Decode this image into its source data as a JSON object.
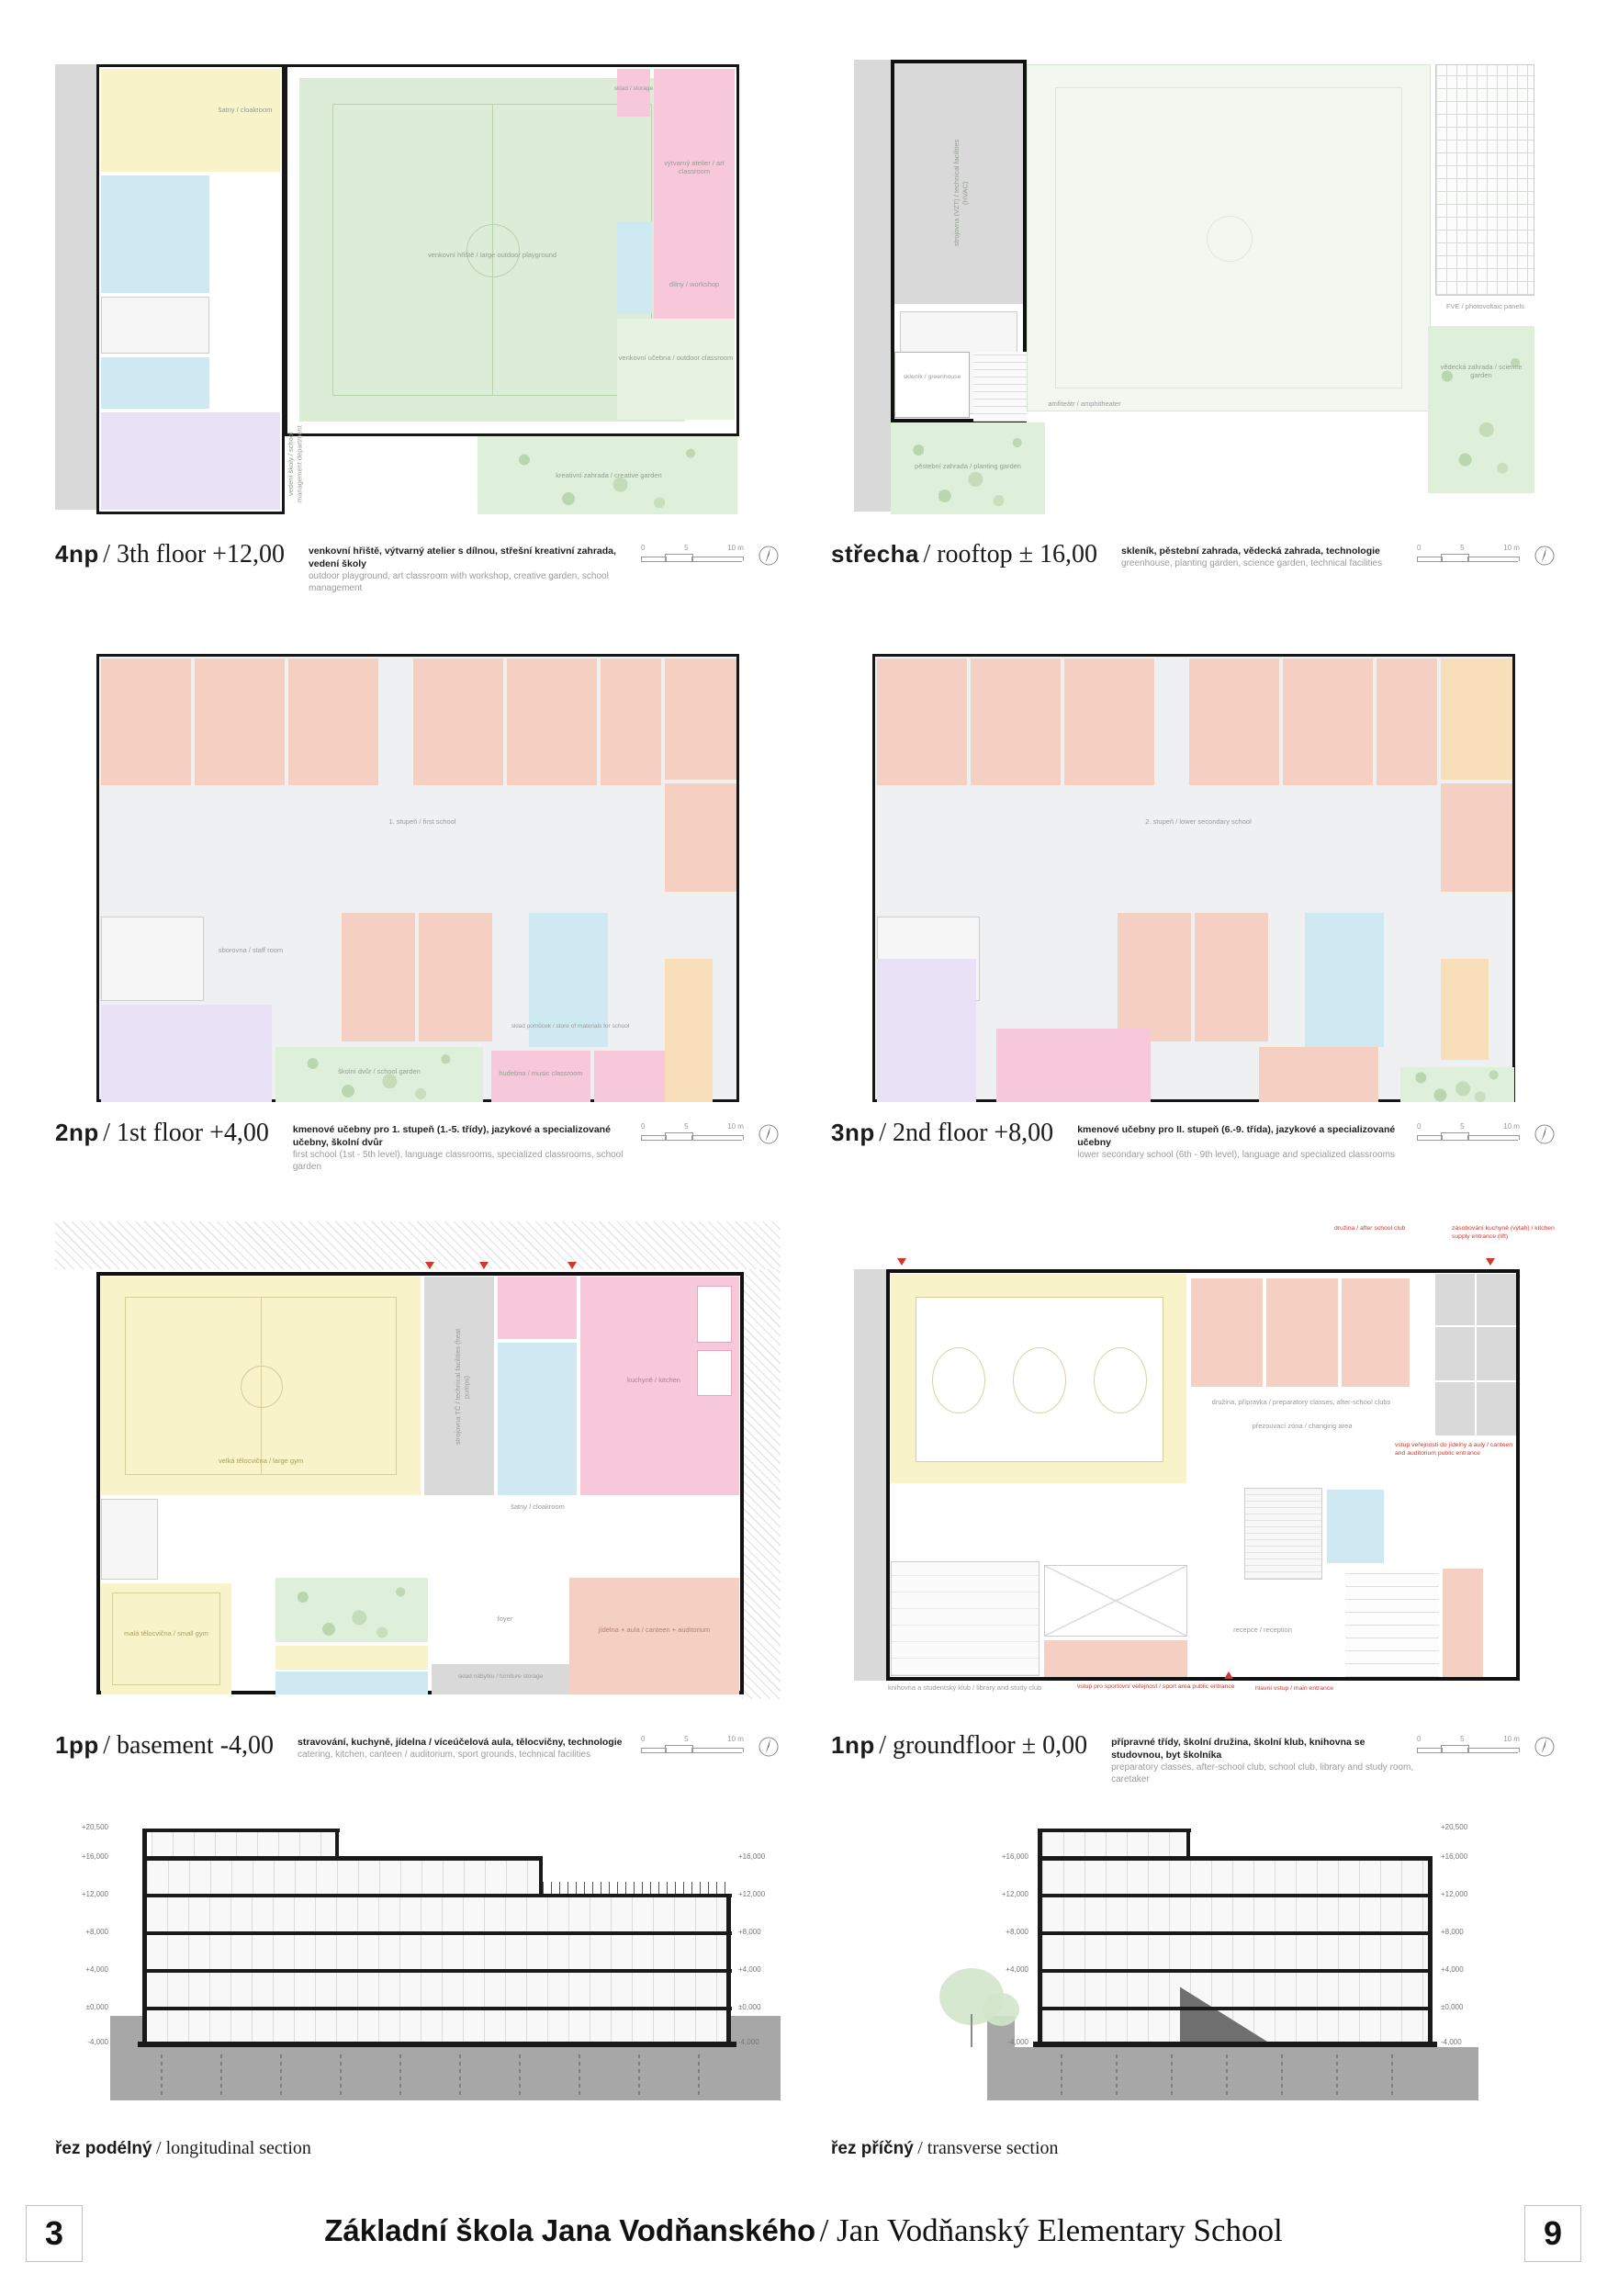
{
  "footer": {
    "page_left": "3",
    "page_right": "9",
    "title_cs": "Základní škola Jana Vodňanského",
    "title_en": "/ Jan Vodňanský Elementary School"
  },
  "scalebar": {
    "t0": "0",
    "t5": "5",
    "t10": "10 m"
  },
  "colors": {
    "outdoor_green": "#dcecd6",
    "classroom_salmon": "#f6cfc3",
    "gym_yellow": "#f8f3c9",
    "sanitary_cyan": "#cfe9f2",
    "offices_lavender": "#e9e1f6",
    "specialized_orange": "#f8dfb9",
    "kitchen_pink": "#f6c8da",
    "annotation_red": "#d0382e"
  },
  "sections": {
    "left": {
      "label_cs": "řez podélný",
      "label_en": "/ longitudinal section"
    },
    "right": {
      "label_cs": "řez příčný",
      "label_en": "/ transverse section"
    },
    "levels": [
      "+20,500",
      "+16,000",
      "+12,000",
      "+8,000",
      "+4,000",
      "±0,000",
      "-4,000"
    ]
  },
  "plans": [
    {
      "code": "4np",
      "title": "/ 3th floor +12,00",
      "desc_cs": "venkovní hřiště, výtvarný atelier s dílnou, střešní kreativní zahrada, vedení školy",
      "desc_en": "outdoor playground, art classroom with workshop, creative garden, school management",
      "labels": {
        "field": "venkovní hřiště / large outdoor playground",
        "garden": "kreativní zahrada / creative garden",
        "outdoor": "venkovní učebna / outdoor classroom",
        "art": "výtvarný atelier / art classroom",
        "workshop": "dílny / workshop",
        "storage": "sklad / storage",
        "cloak": "šatny / cloakroom",
        "mgmt": "vedení školy / school management department"
      }
    },
    {
      "code": "střecha",
      "title": "/ rooftop ± 16,00",
      "desc_cs": "skleník, pěstební zahrada, vědecká zahrada, technologie",
      "desc_en": "greenhouse, planting garden, science garden, technical facilities",
      "labels": {
        "hvac": "strojovna (VZT) / technical facilities (HVAC)",
        "pv": "FVE / photovoltaic panels",
        "science": "vědecká zahrada / science garden",
        "planting": "pěstební zahrada / planting garden",
        "greenhouse": "skleník / greenhouse",
        "amph": "amfiteátr / amphitheater"
      }
    },
    {
      "code": "2np",
      "title": "/ 1st floor +4,00",
      "desc_cs": "kmenové učebny pro 1. stupeň (1.-5. třídy), jazykové a specializované učebny, školní dvůr",
      "desc_en": "first school (1st - 5th level), language classrooms, specialized classrooms, school garden",
      "labels": {
        "center": "1. stupeň / first school",
        "garden": "školní dvůr / school garden",
        "staff": "sborovna / staff room",
        "music": "hudebna / music classroom",
        "store": "sklad pomůcek / store of materials for school"
      }
    },
    {
      "code": "3np",
      "title": "/ 2nd floor +8,00",
      "desc_cs": "kmenové učebny pro II. stupeň (6.-9. třída), jazykové a specializované učebny",
      "desc_en": "lower secondary school (6th - 9th level), language and specialized classrooms",
      "labels": {
        "center": "2. stupeň / lower secondary school"
      }
    },
    {
      "code": "1pp",
      "title": "/ basement -4,00",
      "desc_cs": "stravování, kuchyně, jídelna / víceúčelová aula, tělocvičny, technologie",
      "desc_en": "catering, kitchen, canteen / auditorium, sport grounds, technical facilities",
      "labels": {
        "biggym": "velká tělocvična / large gym",
        "smallgym": "malá tělocvična / small gym",
        "tech": "strojovna TČ / technical facilities (heat pumps)",
        "kitchen": "kuchyně / kitchen",
        "aula": "jídelna + aula / canteen + auditorium",
        "cloak": "šatny / cloakroom",
        "furn": "sklad nábytku / furniture storage",
        "foyer": "foyer"
      }
    },
    {
      "code": "1np",
      "title": "/ groundfloor ± 0,00",
      "desc_cs": "přípravné třídy, školní družina, školní klub, knihovna se studovnou, byt školníka",
      "desc_en": "preparatory classes, after-school club, school club, library and study room, caretaker",
      "labels": {
        "clubs": "družina, přípravka / preparatory classes, after-school clubs",
        "changing": "přezouvací zóna / changing area",
        "library": "knihovna a studentský klub / library and study club",
        "reception": "recepce / reception"
      },
      "annotations": {
        "club": "družina / after school club",
        "supply": "zásobování kuchyně (výtah) / kitchen supply entrance (lift)",
        "canteen_public": "vstup veřejnosti do jídelny a auly / canteen and auditorium public entrance",
        "sport": "vstup pro sportovní veřejnost / sport area public entrance",
        "main": "hlavní vstup / main entrance"
      }
    }
  ]
}
